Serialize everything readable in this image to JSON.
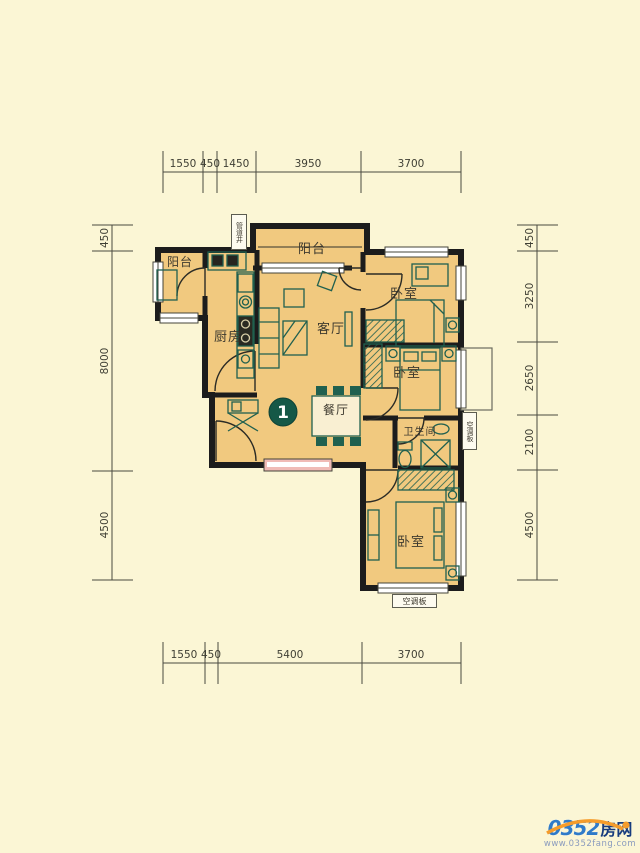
{
  "page": {
    "bg": "#FBF6D5"
  },
  "plan": {
    "unit_badge": "1",
    "labels": {
      "balcony_top": "阳台",
      "balcony_left": "阳台",
      "kitchen": "厨房",
      "living_room": "客厅",
      "dining_room": "餐厅",
      "bedroom_top": "卧室",
      "bedroom_middle": "卧室",
      "bedroom_bottom": "卧室",
      "bathroom": "卫生间",
      "duct_shaft": "管道井",
      "ac_panel_right": "空调板",
      "ac_panel_bottom": "空调板"
    },
    "colors": {
      "room_fill": "#F1C97F",
      "wall": "#1C1C1C",
      "furniture": "#20604F",
      "window_pink": "#F0BBB6",
      "badge": "#155847"
    }
  },
  "dimensions": {
    "top": [
      "1550",
      "450",
      "1450",
      "3950",
      "3700"
    ],
    "bottom": [
      "1550",
      "450",
      "5400",
      "3700"
    ],
    "left": [
      "450",
      "8000",
      "4500"
    ],
    "right": [
      "450",
      "3250",
      "2650",
      "2100",
      "4500"
    ]
  },
  "watermark": {
    "site_number": "0352",
    "site_name": "房网",
    "url": "www.0352fang.com"
  }
}
